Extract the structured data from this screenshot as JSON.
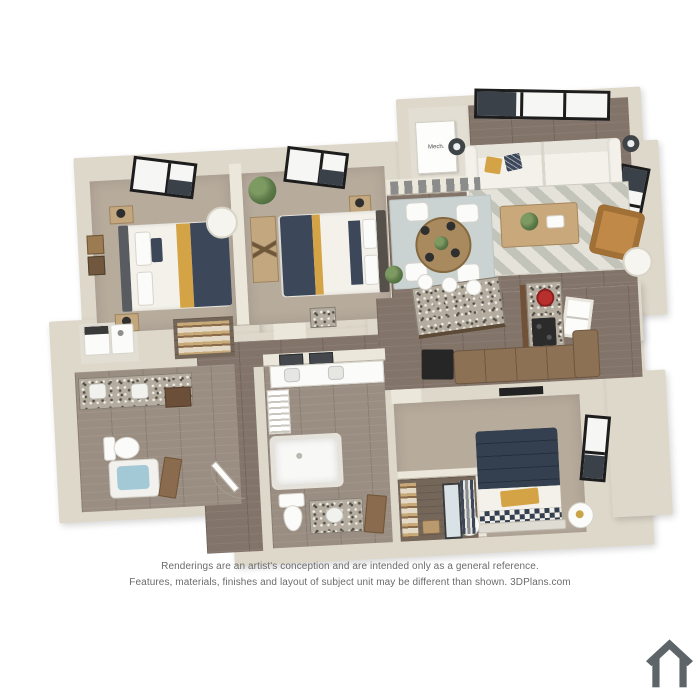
{
  "disclaimer": {
    "line1": "Renderings are an artist's conception and are intended only as a general reference.",
    "line2": "Features, materials, finishes and layout of subject unit may be different than shown. 3DPlans.com"
  },
  "labels": {
    "mech_closet": "Mech."
  },
  "icons": {
    "bottom_right_logo": "house-icon"
  },
  "palette": {
    "bg": "#ffffff",
    "wall": "#ded8ca",
    "wall_light": "#ece7db",
    "wall_edge": "#b9b2a2",
    "carpet": "#b7ab9c",
    "wood": "#83746a",
    "bath_floor": "#9a8d81",
    "closet_floor": "#746659",
    "navy": "#3c4759",
    "navy_dark": "#343f50",
    "mustard": "#d4a345",
    "white_fabric": "#f3f1ea",
    "rug_dining": "#cbd2d2",
    "granite": "#b3ac9f",
    "cabinet": "#8a6b4e",
    "sectional_brown": "#8d7154",
    "leather": "#c08948",
    "water_blue": "#a3c8d6",
    "plant": "#5d7a4a",
    "plant_dark": "#41602f",
    "fixture_white": "#fbfbfa",
    "accent_red": "#b8302e",
    "text_gray": "#6b6b6b",
    "icon_gray": "#5d6569"
  }
}
